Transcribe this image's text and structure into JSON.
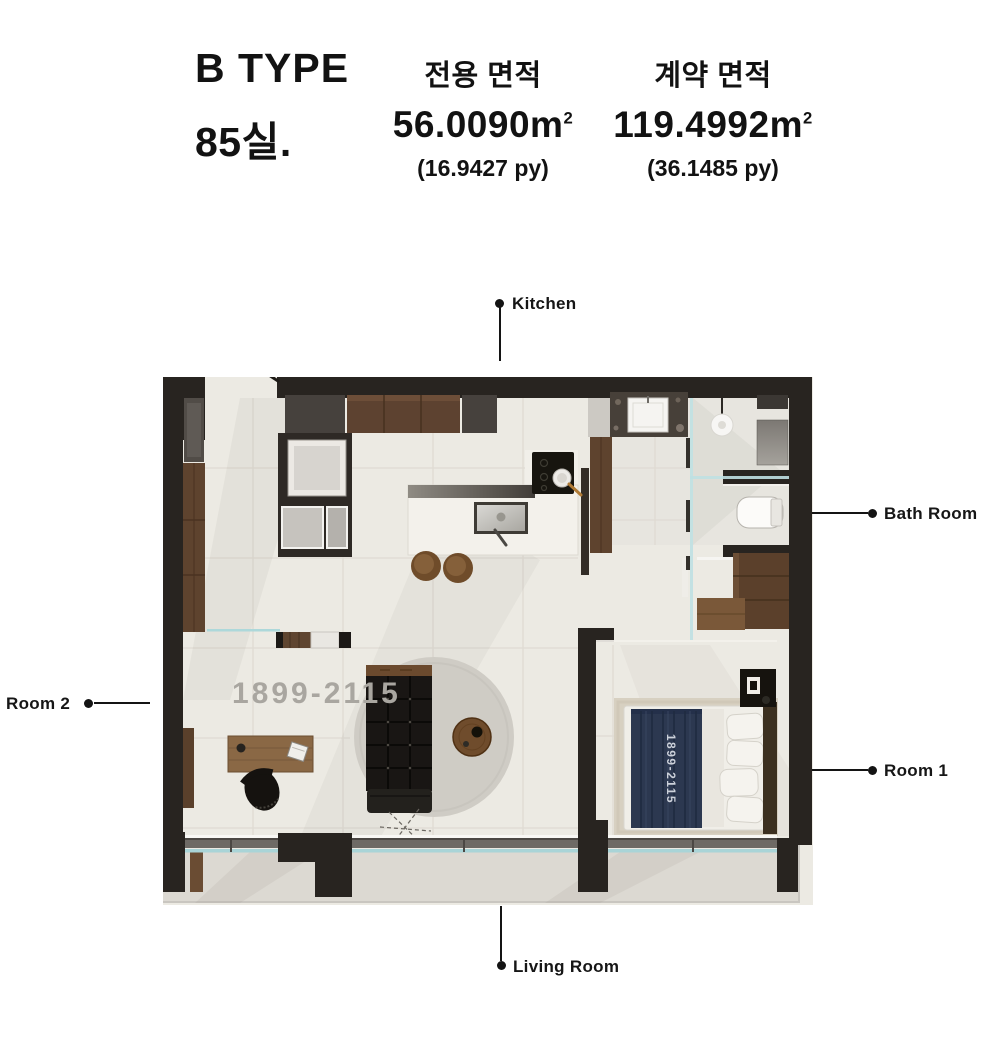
{
  "header": {
    "type_label": "B TYPE",
    "room_label": "85실.",
    "columns": [
      {
        "title": "전용 면적",
        "value": "56.0090",
        "unit_base": "m",
        "unit_exp": "2",
        "py": "(16.9427 py)"
      },
      {
        "title": "계약 면적",
        "value": "119.4992",
        "unit_base": "m",
        "unit_exp": "2",
        "py": "(36.1485 py)"
      }
    ]
  },
  "plan": {
    "labels": {
      "kitchen": "Kitchen",
      "bath": "Bath Room",
      "room1": "Room 1",
      "room2": "Room 2",
      "living": "Living Room"
    },
    "watermark_floor": "1899-2115",
    "watermark_bed": "1899-2115"
  },
  "colors": {
    "wall": "#282420",
    "floor": "#eceae3",
    "balcony_floor": "#dcd9d2",
    "wood": "#5e432e",
    "glass_line": "#a9d4d7",
    "blanket_navy": "#2c3850",
    "label_text": "#161616",
    "watermark_gray": "#a9a6a0"
  }
}
